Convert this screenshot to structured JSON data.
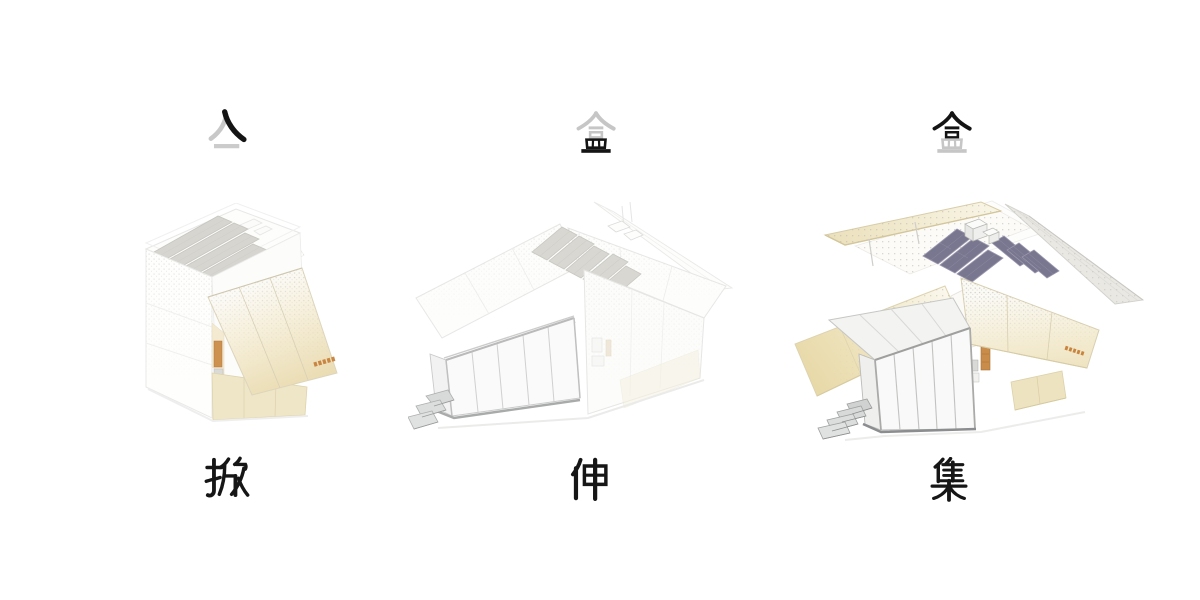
{
  "canvas": {
    "width": 1200,
    "height": 600,
    "background": "#ffffff"
  },
  "palette": {
    "ink_black": "#161616",
    "ghost_gray": "#c6c6c6",
    "ghost_line": "#e6e6e6",
    "cream_panel": "#ecdfb8",
    "solar_gray": "#d8d7d1",
    "solar_purple": "#79768f",
    "accent_orange": "#c67f35",
    "step_gray": "#d8dad9"
  },
  "stages": [
    {
      "id": "stage-lift",
      "top_glyph": {
        "character": "亼",
        "black_strokes": "right falling stroke",
        "gray_strokes": "left falling stroke and base line"
      },
      "house": "closed cabin with striped solar roof and lowered perforated cream flap panel",
      "bottom_label": "掀"
    },
    {
      "id": "stage-extend",
      "top_glyph": {
        "character": "盒",
        "black_strokes": "bottom component 皿",
        "gray_strokes": "top component 合"
      },
      "house": "ghosted cabin with both roof wings opened and a glazed sunroom extended with entry steps",
      "bottom_label": "伸"
    },
    {
      "id": "stage-collect",
      "top_glyph": {
        "character": "盒",
        "black_strokes": "top component 合",
        "gray_strokes": "bottom component 皿"
      },
      "house": "fully deployed cabin with cream perforated wings, dark solar array, rear canopy, sunroom and steps",
      "bottom_label": "集"
    }
  ]
}
